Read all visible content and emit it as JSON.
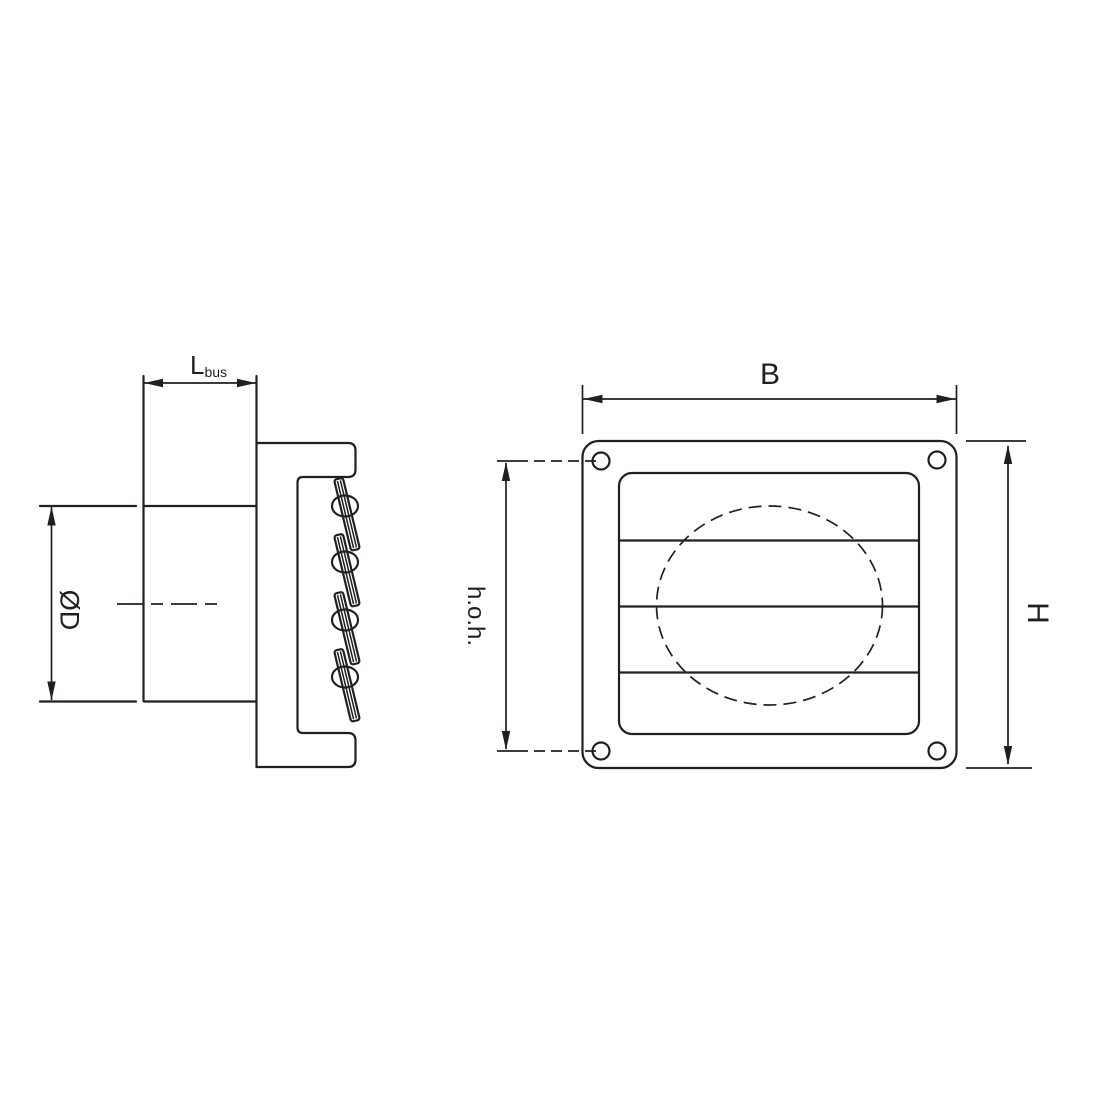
{
  "labels": {
    "duct_length_main": "L",
    "duct_length_sub": "bus",
    "duct_diameter": "ØD",
    "grille_width": "B",
    "hole_spacing": "h.o.h.",
    "grille_height": "H"
  },
  "colors": {
    "line": "#231f20",
    "background": "#ffffff"
  }
}
